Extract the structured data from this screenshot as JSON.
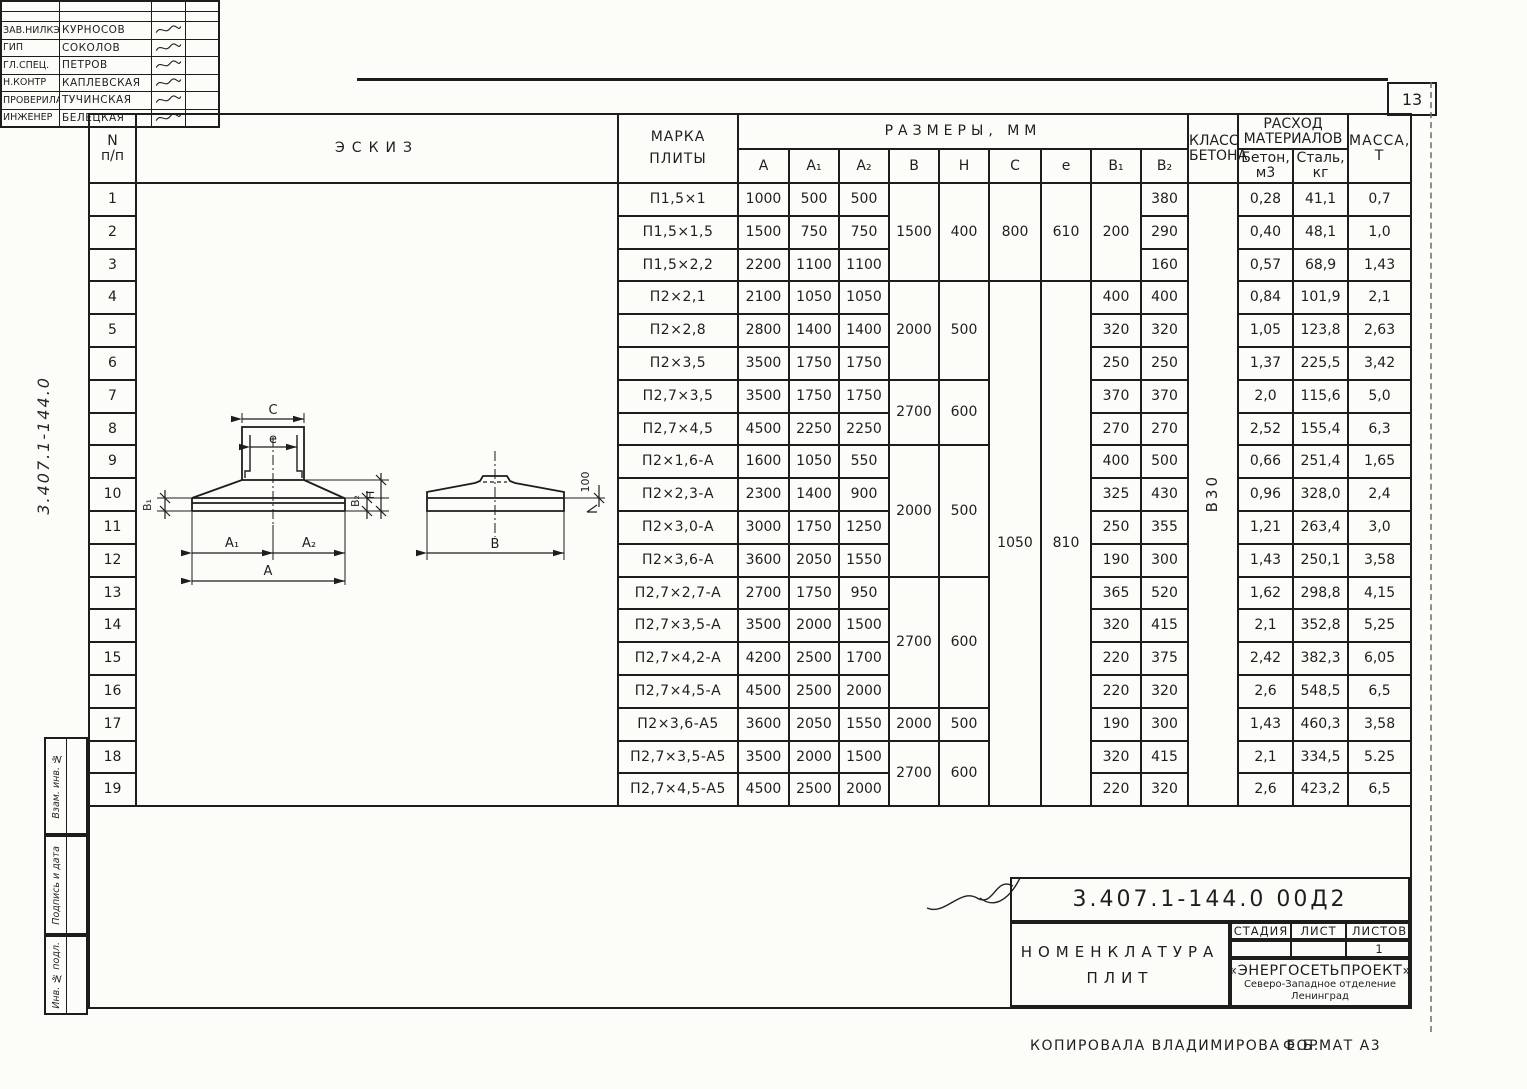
{
  "page": {
    "number": "13"
  },
  "side": {
    "doc_number": "3.407.1-144.0",
    "stamps": [
      "Взам. инв. №",
      "Подпись и дата",
      "Инв. № подл."
    ]
  },
  "table": {
    "header": {
      "n_top": "N",
      "n_bottom": "п/п",
      "sketch": "Эскиз",
      "marka": [
        "Марка",
        "плиты"
      ],
      "razmery": "Размеры, мм",
      "dims": [
        "А",
        "А₁",
        "А₂",
        "В",
        "Н",
        "С",
        "е",
        "В₁",
        "В₂"
      ],
      "klass": [
        "Класс",
        "бетона"
      ],
      "rashod": [
        "Расход",
        "материалов"
      ],
      "beton": [
        "Бетон,",
        "м3"
      ],
      "stal": [
        "Сталь,",
        "кг"
      ],
      "massa": [
        "Масса,",
        "т"
      ]
    },
    "class_beton": "В30",
    "rows": [
      {
        "n": "1",
        "marka": "П1,5×1",
        "vals": [
          "1000",
          "500",
          "500",
          {
            "v": "1500",
            "rs": 3
          },
          {
            "v": "400",
            "rs": 3
          },
          {
            "v": "800",
            "rs": 3
          },
          {
            "v": "610",
            "rs": 3
          },
          {
            "v": "200",
            "rs": 3
          },
          "380",
          "0,28",
          "41,1",
          "0,7"
        ]
      },
      {
        "n": "2",
        "marka": "П1,5×1,5",
        "vals": [
          "1500",
          "750",
          "750",
          null,
          null,
          null,
          null,
          null,
          "290",
          "0,40",
          "48,1",
          "1,0"
        ]
      },
      {
        "n": "3",
        "marka": "П1,5×2,2",
        "vals": [
          "2200",
          "1100",
          "1100",
          null,
          null,
          null,
          null,
          null,
          "160",
          "0,57",
          "68,9",
          "1,43"
        ]
      },
      {
        "n": "4",
        "marka": "П2×2,1",
        "vals": [
          "2100",
          "1050",
          "1050",
          {
            "v": "2000",
            "rs": 3
          },
          {
            "v": "500",
            "rs": 3
          },
          {
            "v": "1050",
            "rs": 16
          },
          {
            "v": "810",
            "rs": 16
          },
          "400",
          "400",
          "0,84",
          "101,9",
          "2,1"
        ]
      },
      {
        "n": "5",
        "marka": "П2×2,8",
        "vals": [
          "2800",
          "1400",
          "1400",
          null,
          null,
          null,
          null,
          "320",
          "320",
          "1,05",
          "123,8",
          "2,63"
        ]
      },
      {
        "n": "6",
        "marka": "П2×3,5",
        "vals": [
          "3500",
          "1750",
          "1750",
          null,
          null,
          null,
          null,
          "250",
          "250",
          "1,37",
          "225,5",
          "3,42"
        ]
      },
      {
        "n": "7",
        "marka": "П2,7×3,5",
        "vals": [
          "3500",
          "1750",
          "1750",
          {
            "v": "2700",
            "rs": 2
          },
          {
            "v": "600",
            "rs": 2
          },
          null,
          null,
          "370",
          "370",
          "2,0",
          "115,6",
          "5,0"
        ]
      },
      {
        "n": "8",
        "marka": "П2,7×4,5",
        "vals": [
          "4500",
          "2250",
          "2250",
          null,
          null,
          null,
          null,
          "270",
          "270",
          "2,52",
          "155,4",
          "6,3"
        ]
      },
      {
        "n": "9",
        "marka": "П2×1,6-А",
        "vals": [
          "1600",
          "1050",
          "550",
          {
            "v": "2000",
            "rs": 4
          },
          {
            "v": "500",
            "rs": 4
          },
          null,
          null,
          "400",
          "500",
          "0,66",
          "251,4",
          "1,65"
        ]
      },
      {
        "n": "10",
        "marka": "П2×2,3-А",
        "vals": [
          "2300",
          "1400",
          "900",
          null,
          null,
          null,
          null,
          "325",
          "430",
          "0,96",
          "328,0",
          "2,4"
        ]
      },
      {
        "n": "11",
        "marka": "П2×3,0-А",
        "vals": [
          "3000",
          "1750",
          "1250",
          null,
          null,
          null,
          null,
          "250",
          "355",
          "1,21",
          "263,4",
          "3,0"
        ]
      },
      {
        "n": "12",
        "marka": "П2×3,6-А",
        "vals": [
          "3600",
          "2050",
          "1550",
          null,
          null,
          null,
          null,
          "190",
          "300",
          "1,43",
          "250,1",
          "3,58"
        ]
      },
      {
        "n": "13",
        "marka": "П2,7×2,7-А",
        "vals": [
          "2700",
          "1750",
          "950",
          {
            "v": "2700",
            "rs": 4
          },
          {
            "v": "600",
            "rs": 4
          },
          null,
          null,
          "365",
          "520",
          "1,62",
          "298,8",
          "4,15"
        ]
      },
      {
        "n": "14",
        "marka": "П2,7×3,5-А",
        "vals": [
          "3500",
          "2000",
          "1500",
          null,
          null,
          null,
          null,
          "320",
          "415",
          "2,1",
          "352,8",
          "5,25"
        ]
      },
      {
        "n": "15",
        "marka": "П2,7×4,2-А",
        "vals": [
          "4200",
          "2500",
          "1700",
          null,
          null,
          null,
          null,
          "220",
          "375",
          "2,42",
          "382,3",
          "6,05"
        ]
      },
      {
        "n": "16",
        "marka": "П2,7×4,5-А",
        "vals": [
          "4500",
          "2500",
          "2000",
          null,
          null,
          null,
          null,
          "220",
          "320",
          "2,6",
          "548,5",
          "6,5"
        ]
      },
      {
        "n": "17",
        "marka": "П2×3,6-А5",
        "vals": [
          "3600",
          "2050",
          "1550",
          "2000",
          "500",
          null,
          null,
          "190",
          "300",
          "1,43",
          "460,3",
          "3,58"
        ]
      },
      {
        "n": "18",
        "marka": "П2,7×3,5-А5",
        "vals": [
          "3500",
          "2000",
          "1500",
          {
            "v": "2700",
            "rs": 2
          },
          {
            "v": "600",
            "rs": 2
          },
          null,
          null,
          "320",
          "415",
          "2,1",
          "334,5",
          "5.25"
        ]
      },
      {
        "n": "19",
        "marka": "П2,7×4,5-А5",
        "vals": [
          "4500",
          "2500",
          "2000",
          null,
          null,
          null,
          null,
          "220",
          "320",
          "2,6",
          "423,2",
          "6,5"
        ]
      }
    ]
  },
  "sketch": {
    "labels": {
      "c": "С",
      "e": "е",
      "b1": "В₁",
      "b2": "В₂",
      "h": "Н",
      "a1": "А₁",
      "a2": "А₂",
      "a": "А",
      "b": "В",
      "t100": "100"
    }
  },
  "title_block": {
    "doc_number": "3.407.1-144.0  00Д2",
    "title_line1": "Номенклатура",
    "title_line2": "плит",
    "signers": [
      {
        "role": "Зав.НИЛКЭ",
        "name": "Курносов"
      },
      {
        "role": "ГИП",
        "name": "Соколов"
      },
      {
        "role": "Гл.спец.",
        "name": "Петров"
      },
      {
        "role": "Н.контр",
        "name": "Каплевская"
      },
      {
        "role": "Проверила",
        "name": "Тучинская"
      },
      {
        "role": "Инженер",
        "name": "Белецкая"
      }
    ],
    "stage_label": "Стадия",
    "sheet_label": "Лист",
    "sheets_label": "Листов",
    "sheets_value": "1",
    "org_line1": "«ЭНЕРГОСЕТЬПРОЕКТ»",
    "org_line2": "Северо-Западное отделение",
    "org_line3": "Ленинград"
  },
  "footer": {
    "copied": "Копировала Владимирова Е.Б.",
    "format": "ФОРМАТ А3"
  }
}
